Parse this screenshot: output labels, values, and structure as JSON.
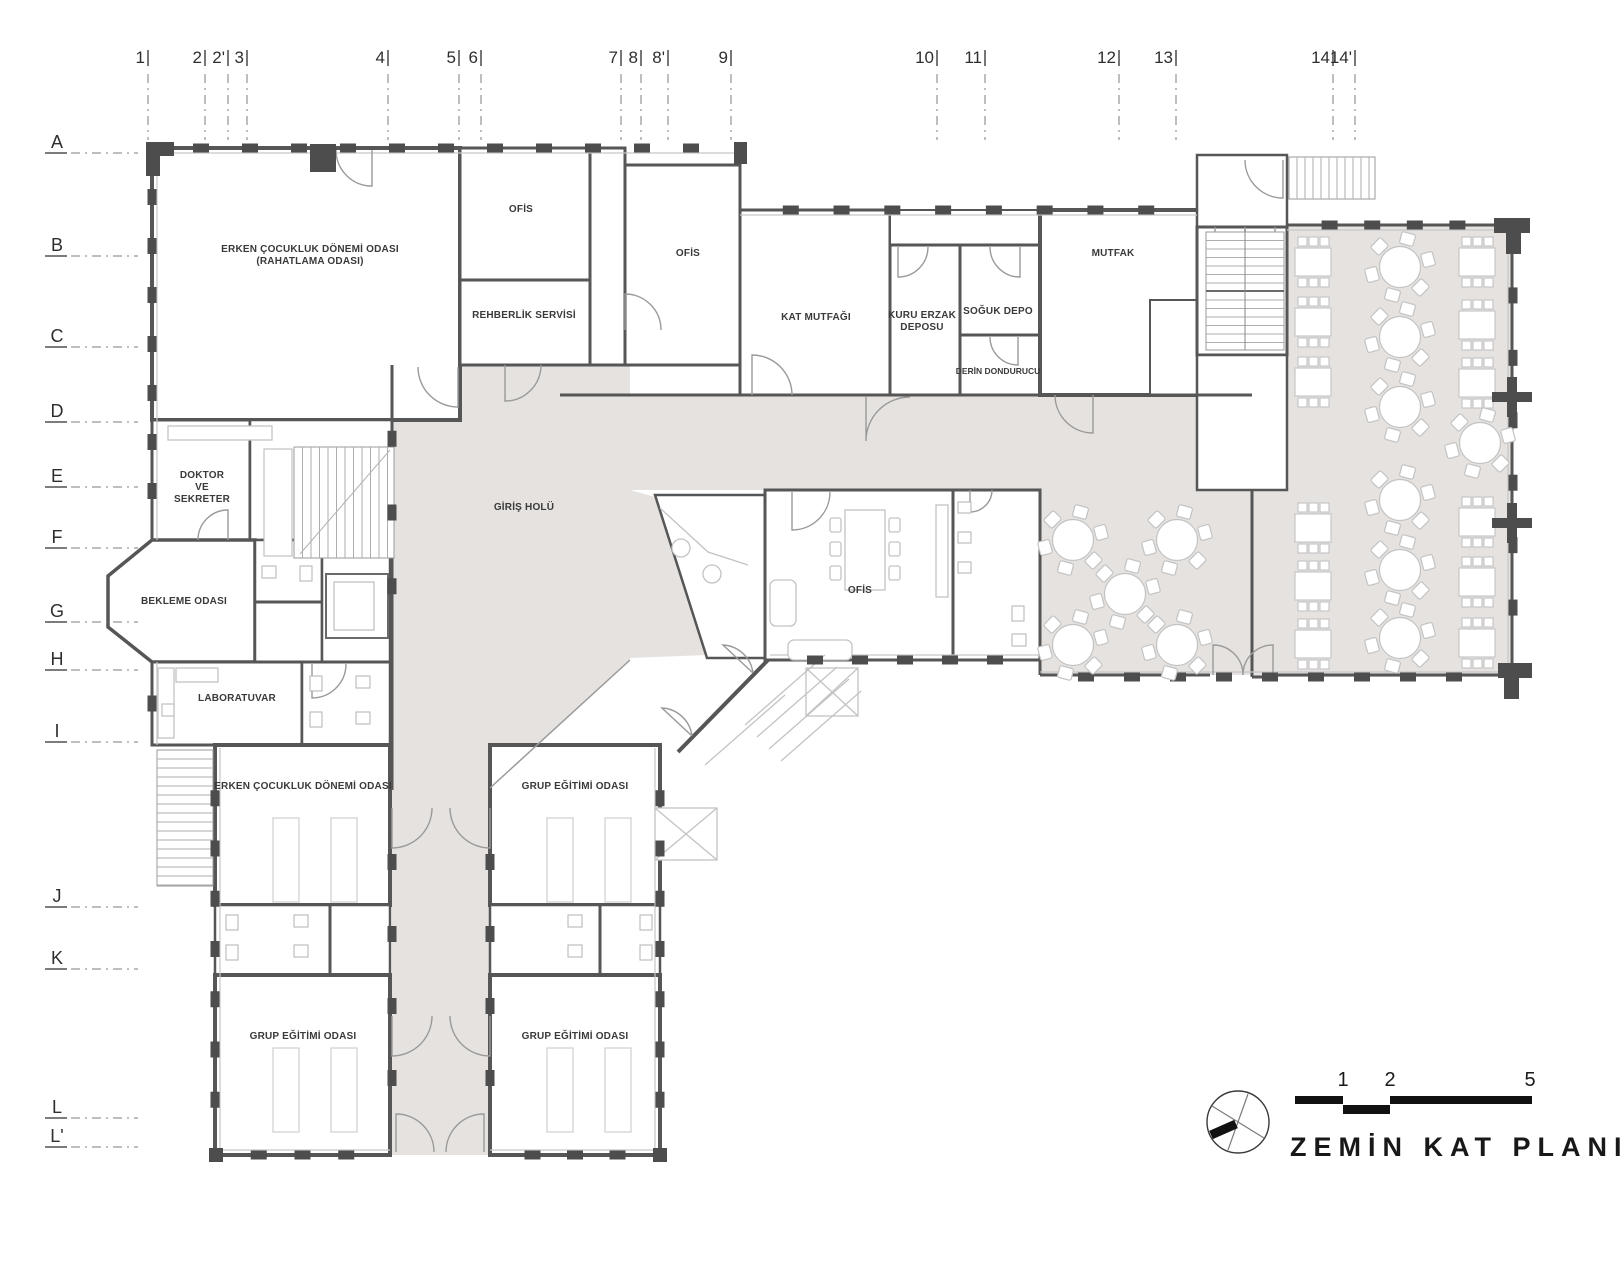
{
  "title": {
    "text": "ZEMİN KAT PLANI"
  },
  "scale_bar": {
    "labels": [
      "1",
      "2",
      "5"
    ]
  },
  "compass": {
    "icon": "north-arrow-icon"
  },
  "grid": {
    "columns": [
      {
        "label": "1",
        "x": 148
      },
      {
        "label": "2",
        "x": 205
      },
      {
        "label": "2'",
        "x": 228
      },
      {
        "label": "3",
        "x": 247
      },
      {
        "label": "4",
        "x": 388
      },
      {
        "label": "5",
        "x": 459
      },
      {
        "label": "6",
        "x": 481
      },
      {
        "label": "7",
        "x": 621
      },
      {
        "label": "8",
        "x": 641
      },
      {
        "label": "8'",
        "x": 668
      },
      {
        "label": "9",
        "x": 731
      },
      {
        "label": "10",
        "x": 937
      },
      {
        "label": "11",
        "x": 985
      },
      {
        "label": "12",
        "x": 1119
      },
      {
        "label": "13",
        "x": 1176
      },
      {
        "label": "14",
        "x": 1333
      },
      {
        "label": "14'",
        "x": 1355
      }
    ],
    "rows": [
      {
        "label": "A",
        "y": 142
      },
      {
        "label": "B",
        "y": 245
      },
      {
        "label": "C",
        "y": 336
      },
      {
        "label": "D",
        "y": 411
      },
      {
        "label": "E",
        "y": 476
      },
      {
        "label": "F",
        "y": 537
      },
      {
        "label": "G",
        "y": 611
      },
      {
        "label": "H",
        "y": 659
      },
      {
        "label": "I",
        "y": 731
      },
      {
        "label": "J",
        "y": 896
      },
      {
        "label": "K",
        "y": 958
      },
      {
        "label": "L",
        "y": 1107
      },
      {
        "label": "L'",
        "y": 1136
      }
    ]
  },
  "rooms": [
    {
      "name": "early-childhood-relaxation-room",
      "cx": 310,
      "cy": 252,
      "lines": [
        "ERKEN ÇOCUKLUK DÖNEMİ ODASI",
        "(RAHATLAMA ODASI)"
      ]
    },
    {
      "name": "office-1",
      "cx": 521,
      "cy": 212,
      "lines": [
        "OFİS"
      ]
    },
    {
      "name": "guidance-service",
      "cx": 524,
      "cy": 318,
      "lines": [
        "REHBERLİK SERVİSİ"
      ]
    },
    {
      "name": "office-2",
      "cx": 688,
      "cy": 256,
      "lines": [
        "OFİS"
      ]
    },
    {
      "name": "floor-kitchen",
      "cx": 816,
      "cy": 320,
      "lines": [
        "KAT MUTFAĞI"
      ]
    },
    {
      "name": "dry-food-storage",
      "cx": 922,
      "cy": 318,
      "lines": [
        "KURU ERZAK",
        "DEPOSU"
      ]
    },
    {
      "name": "cold-storage",
      "cx": 998,
      "cy": 314,
      "lines": [
        "SOĞUK DEPO"
      ]
    },
    {
      "name": "deep-freezer",
      "cx": 998,
      "cy": 374,
      "small": true,
      "lines": [
        "DERİN DONDURUCU"
      ]
    },
    {
      "name": "kitchen",
      "cx": 1113,
      "cy": 256,
      "lines": [
        "MUTFAK"
      ]
    },
    {
      "name": "entrance-hall",
      "cx": 524,
      "cy": 510,
      "lines": [
        "GİRİŞ HOLÜ"
      ]
    },
    {
      "name": "doctor-secretary",
      "cx": 202,
      "cy": 478,
      "lines": [
        "DOKTOR",
        "VE",
        "SEKRETER"
      ]
    },
    {
      "name": "waiting-room",
      "cx": 184,
      "cy": 604,
      "lines": [
        "BEKLEME ODASI"
      ]
    },
    {
      "name": "laboratory",
      "cx": 237,
      "cy": 701,
      "lines": [
        "LABORATUVAR"
      ]
    },
    {
      "name": "office-3",
      "cx": 860,
      "cy": 593,
      "lines": [
        "OFİS"
      ]
    },
    {
      "name": "early-childhood-room",
      "cx": 303,
      "cy": 789,
      "lines": [
        "ERKEN ÇOCUKLUK DÖNEMİ ODASI"
      ]
    },
    {
      "name": "group-education-room-1",
      "cx": 575,
      "cy": 789,
      "lines": [
        "GRUP EĞİTİMİ ODASI"
      ]
    },
    {
      "name": "group-education-room-2",
      "cx": 303,
      "cy": 1039,
      "lines": [
        "GRUP EĞİTİMİ ODASI"
      ]
    },
    {
      "name": "group-education-room-3",
      "cx": 575,
      "cy": 1039,
      "lines": [
        "GRUP EĞİTİMİ ODASI"
      ]
    }
  ],
  "colors": {
    "wall": "#565656",
    "pier": "#4d4d4d",
    "floor": "#e5e2df",
    "light_line": "#c6c6c6",
    "furniture": "#c3c3c3",
    "text": "#3a3a3a",
    "black": "#111111"
  }
}
